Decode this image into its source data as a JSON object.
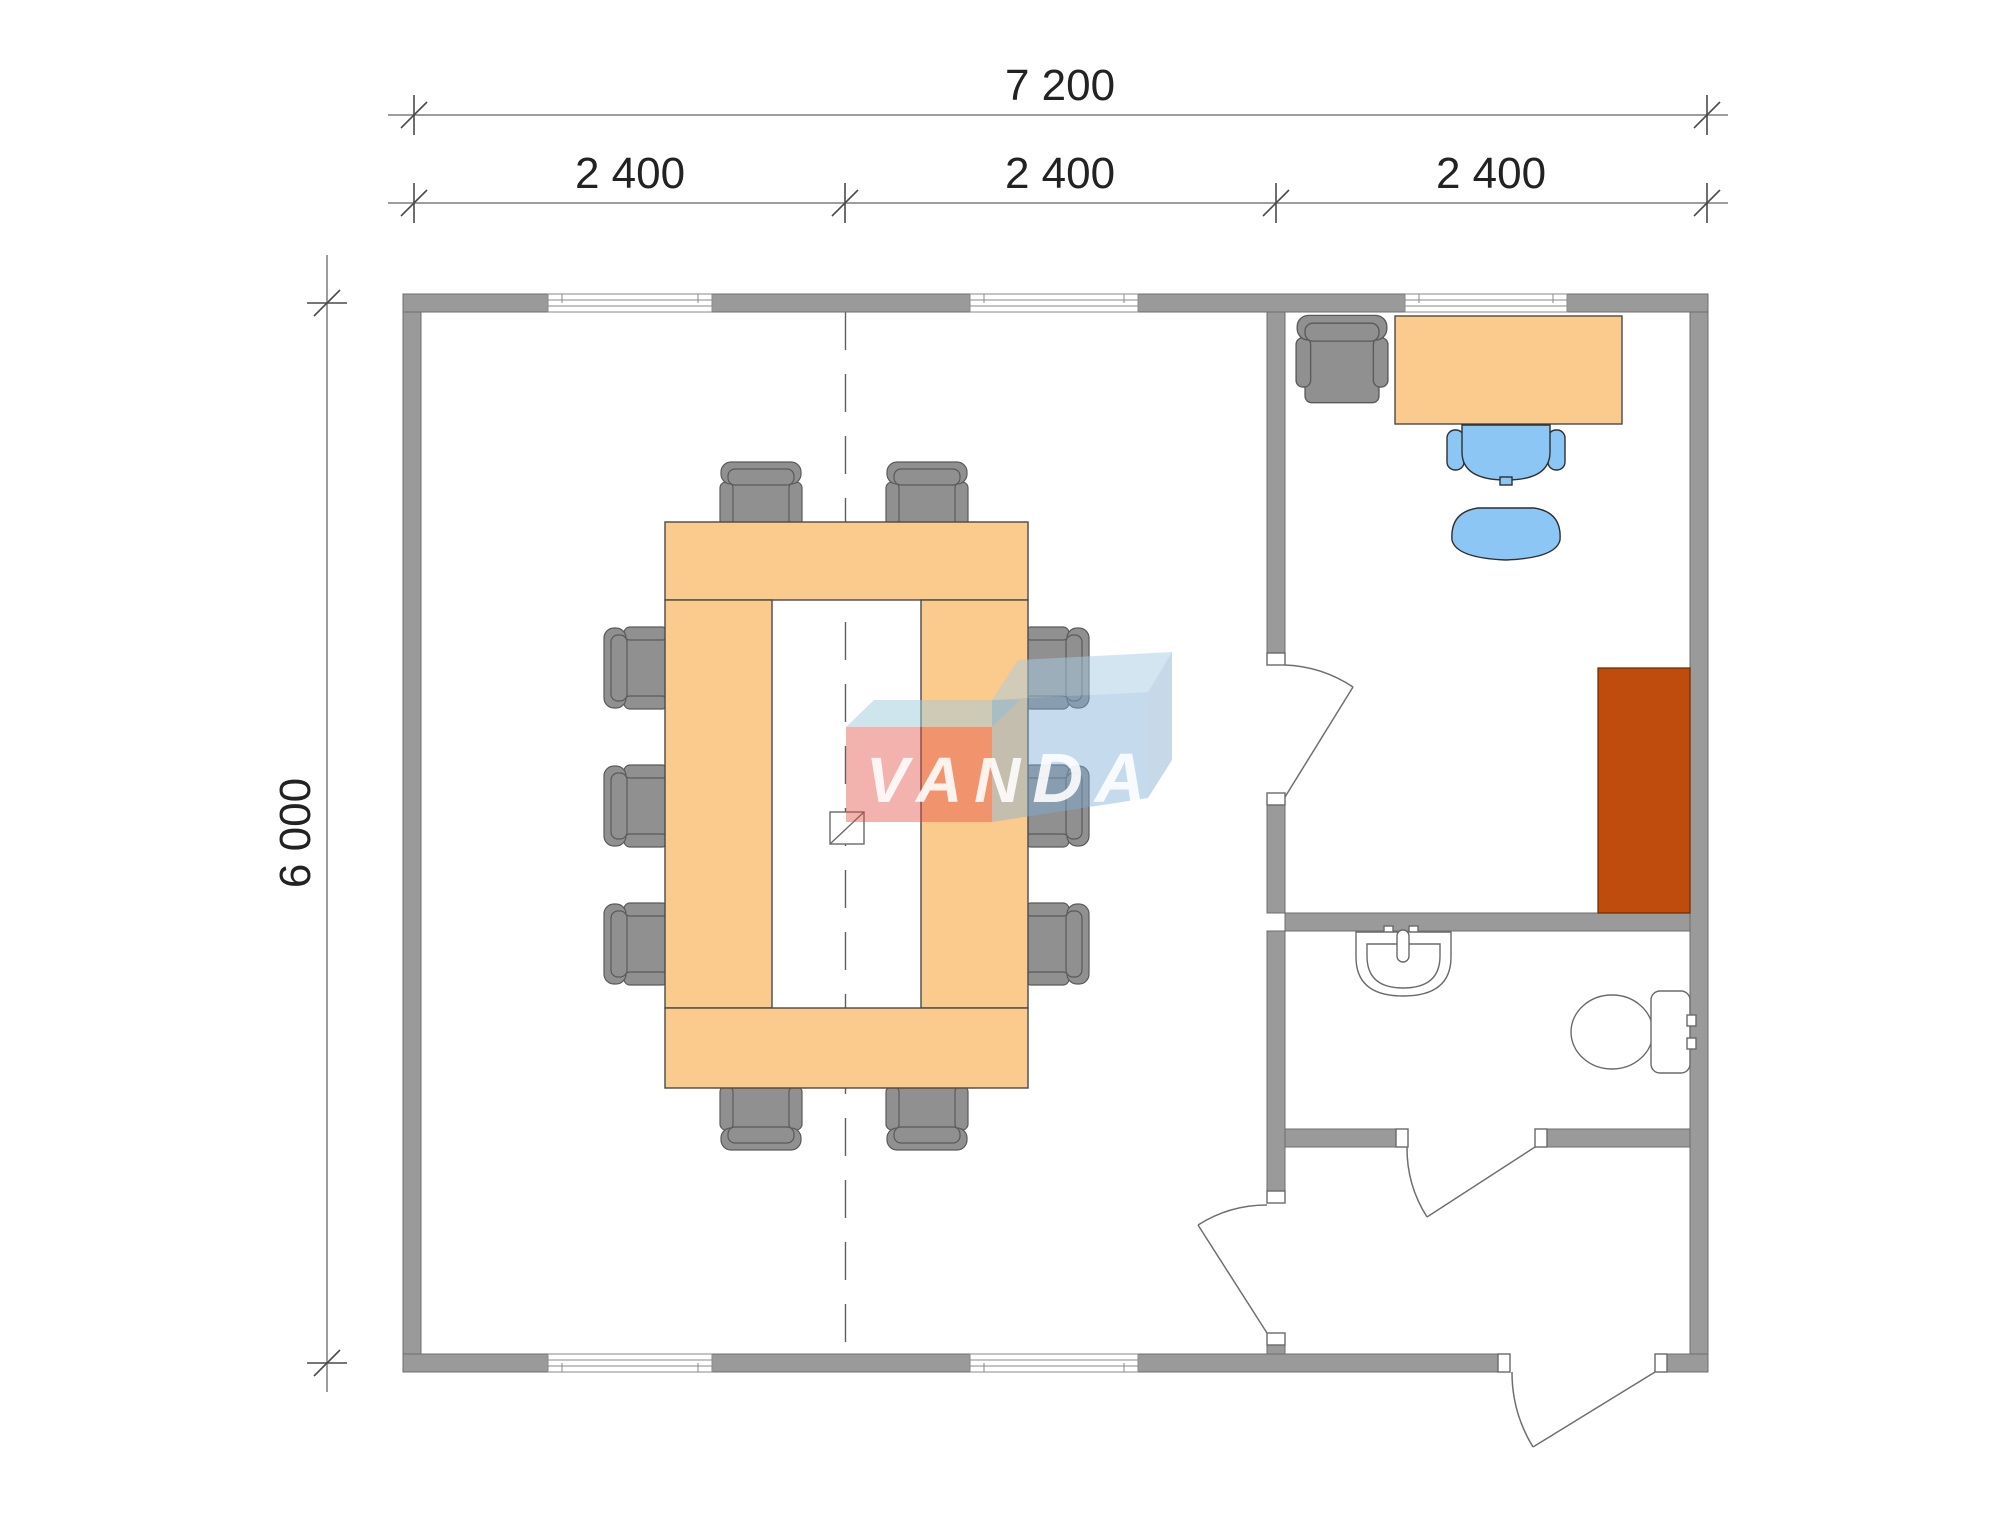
{
  "plan": {
    "title": "Modular building floor plan 7200x6000",
    "rooms": [
      "meeting-room",
      "office",
      "bathroom",
      "entry-hall"
    ]
  },
  "dimensions": {
    "overall_width": "7 200",
    "modules": [
      "2 400",
      "2 400",
      "2 400"
    ],
    "overall_height": "6 000"
  },
  "logo": {
    "left": "VAN",
    "right": "DA"
  },
  "colors": {
    "wall": "#9a9a9a",
    "furniture_peach": "#fbca8d",
    "chair_gray": "#909090",
    "chair_back_gray": "#9b9b9b",
    "chair_blue": "#8cc6f5",
    "cabinet_rust": "#bf4b0d",
    "logo_red": "#e2473f",
    "logo_top": "#9fccde",
    "logo_blue": "#7fafd6",
    "logo_blue_top": "#a8cce4",
    "logo_blue_side": "#8fb4d2",
    "logo_text": "#ffffff"
  }
}
